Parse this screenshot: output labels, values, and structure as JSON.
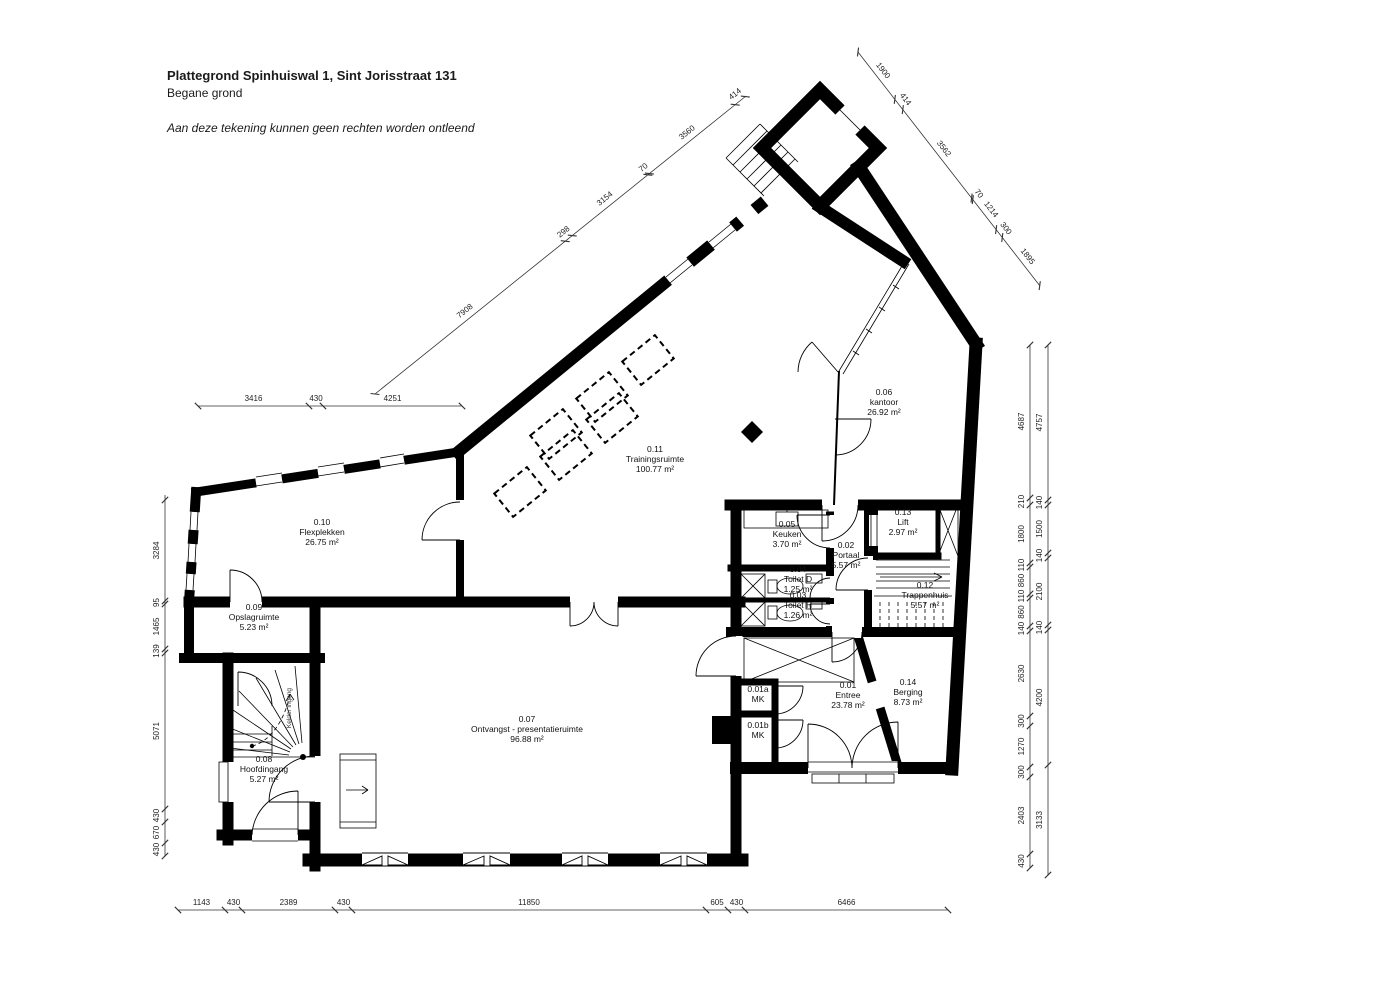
{
  "title": {
    "line1": "Plattegrond Spinhuiswal 1, Sint Jorisstraat 131",
    "line2": "Begane grond",
    "note": "Aan deze tekening kunnen geen rechten worden ontleend"
  },
  "rooms": [
    {
      "num": "0.01",
      "name": "Entree",
      "area": "23.78 m²",
      "x": 848,
      "y": 688
    },
    {
      "num": "0.01a",
      "name": "MK",
      "area": "",
      "x": 758,
      "y": 692
    },
    {
      "num": "0.01b",
      "name": "MK",
      "area": "",
      "x": 758,
      "y": 728
    },
    {
      "num": "0.02",
      "name": "Portaal",
      "area": "5.57 m²",
      "x": 846,
      "y": 548
    },
    {
      "num": "0.03",
      "name": "Toilet H",
      "area": "1.26 m²",
      "x": 798,
      "y": 598
    },
    {
      "num": "0.04",
      "name": "Toilet D",
      "area": "1.25 m²",
      "x": 798,
      "y": 572
    },
    {
      "num": "0.05",
      "name": "Keuken",
      "area": "3.70 m²",
      "x": 787,
      "y": 527
    },
    {
      "num": "0.06",
      "name": "kantoor",
      "area": "26.92 m²",
      "x": 884,
      "y": 395
    },
    {
      "num": "0.07",
      "name": "Ontvangst - presentatieruimte",
      "area": "96.88 m²",
      "x": 527,
      "y": 722
    },
    {
      "num": "0.08",
      "name": "Hoofdingang",
      "area": "5.27 m²",
      "x": 264,
      "y": 762
    },
    {
      "num": "0.09",
      "name": "Opslagruimte",
      "area": "5.23 m²",
      "x": 254,
      "y": 610
    },
    {
      "num": "0.10",
      "name": "Flexplekken",
      "area": "26.75 m²",
      "x": 322,
      "y": 525
    },
    {
      "num": "0.11",
      "name": "Trainingsruimte",
      "area": "100.77 m²",
      "x": 655,
      "y": 452
    },
    {
      "num": "0.12",
      "name": "Trappenhuis",
      "area": "5.57 m²",
      "x": 925,
      "y": 588
    },
    {
      "num": "0.13",
      "name": "Lift",
      "area": "2.97 m²",
      "x": 903,
      "y": 515
    },
    {
      "num": "0.14",
      "name": "Berging",
      "area": "8.73 m²",
      "x": 908,
      "y": 685
    }
  ],
  "annotations": [
    {
      "text": "Kelder ingang",
      "x": 291,
      "y": 708,
      "r": -90,
      "size": 6.5
    }
  ],
  "dimensions": [
    {
      "name": "bottom",
      "x1": 178,
      "y1": 910,
      "x2": 948,
      "y2": 910,
      "off": -5,
      "segments": [
        {
          "len": 47,
          "label": "1143"
        },
        {
          "len": 17,
          "label": "430"
        },
        {
          "len": 93,
          "label": "2389"
        },
        {
          "len": 17,
          "label": "430"
        },
        {
          "len": 354,
          "label": "11850"
        },
        {
          "len": 22,
          "label": "605"
        },
        {
          "len": 17,
          "label": "430"
        },
        {
          "len": 203,
          "label": "6466"
        }
      ]
    },
    {
      "name": "left",
      "x1": 165,
      "y1": 856,
      "x2": 165,
      "y2": 495,
      "off": -6,
      "segments": [
        {
          "len": 13,
          "label": "430"
        },
        {
          "len": 21,
          "label": "670"
        },
        {
          "len": 13,
          "label": "430"
        },
        {
          "len": 156,
          "label": "5071"
        },
        {
          "len": 4,
          "label": "139"
        },
        {
          "len": 45,
          "label": "1465"
        },
        {
          "len": 3,
          "label": "95"
        },
        {
          "len": 101,
          "label": "3284"
        }
      ]
    },
    {
      "name": "right-inner",
      "x1": 1030,
      "y1": 868,
      "x2": 1030,
      "y2": 345,
      "off": -6,
      "segments": [
        {
          "len": 14,
          "label": "430"
        },
        {
          "len": 77,
          "label": "2403"
        },
        {
          "len": 10,
          "label": "300"
        },
        {
          "len": 41,
          "label": "1270"
        },
        {
          "len": 10,
          "label": "300"
        },
        {
          "len": 85,
          "label": "2630"
        },
        {
          "len": 5,
          "label": "140"
        },
        {
          "len": 28,
          "label": "860"
        },
        {
          "len": 4,
          "label": "110"
        },
        {
          "len": 27,
          "label": "860"
        },
        {
          "len": 4,
          "label": "110"
        },
        {
          "len": 58,
          "label": "1800"
        },
        {
          "len": 7,
          "label": "210"
        },
        {
          "len": 153,
          "label": "4687"
        }
      ]
    },
    {
      "name": "right-outer",
      "x1": 1048,
      "y1": 875,
      "x2": 1048,
      "y2": 345,
      "off": -6,
      "segments": [
        {
          "len": 110,
          "label": "3133"
        },
        {
          "len": 135,
          "label": "4200"
        },
        {
          "len": 5,
          "label": "140"
        },
        {
          "len": 67,
          "label": "2100"
        },
        {
          "len": 5,
          "label": "140"
        },
        {
          "len": 48,
          "label": "1500"
        },
        {
          "len": 5,
          "label": "140"
        },
        {
          "len": 155,
          "label": "4757"
        }
      ]
    },
    {
      "name": "mid-left",
      "x1": 198,
      "y1": 406,
      "x2": 462,
      "y2": 406,
      "off": -5,
      "segments": [
        {
          "len": 111,
          "label": "3416"
        },
        {
          "len": 14,
          "label": "430"
        },
        {
          "len": 139,
          "label": "4251"
        }
      ]
    },
    {
      "name": "diag-topleft",
      "x1": 375,
      "y1": 394,
      "x2": 746,
      "y2": 96,
      "off": -6,
      "segments": [
        {
          "len": 244,
          "label": "7908"
        },
        {
          "len": 9,
          "label": "298"
        },
        {
          "len": 97,
          "label": "3154"
        },
        {
          "len": 2,
          "label": "70"
        },
        {
          "len": 110,
          "label": "3560"
        },
        {
          "len": 13,
          "label": "414"
        }
      ]
    },
    {
      "name": "diag-topright",
      "x1": 858,
      "y1": 52,
      "x2": 1040,
      "y2": 286,
      "off": -6,
      "segments": [
        {
          "len": 60,
          "label": "1900"
        },
        {
          "len": 13,
          "label": "414"
        },
        {
          "len": 112,
          "label": "3562"
        },
        {
          "len": 2,
          "label": "70"
        },
        {
          "len": 38,
          "label": "1214"
        },
        {
          "len": 10,
          "label": "300"
        },
        {
          "len": 61,
          "label": "1895"
        }
      ]
    }
  ]
}
